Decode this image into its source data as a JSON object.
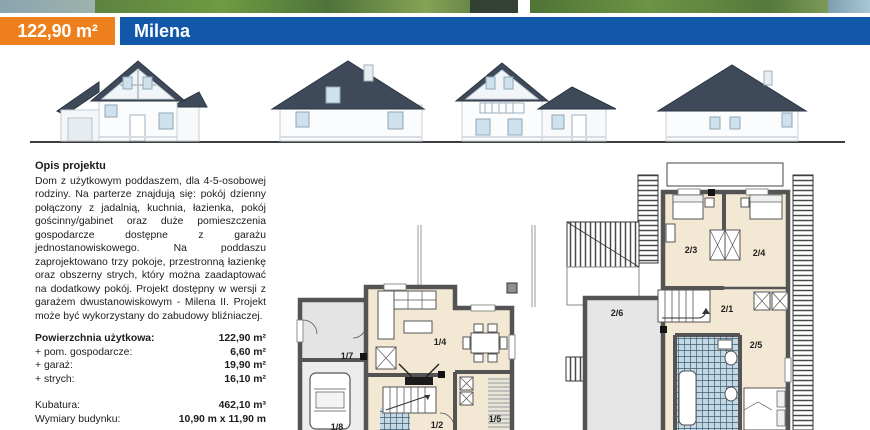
{
  "header": {
    "area": "122,90 m²",
    "title": "Milena",
    "colors": {
      "orange": "#ee7f1d",
      "blue": "#1159a8"
    }
  },
  "description": {
    "heading": "Opis projektu",
    "body": "Dom z użytkowym poddaszem, dla 4-5-osobowej rodziny. Na parterze znajdują się: pokój dzienny połączony z jadalnią, kuchnia, łazienka, pokój gościnny/gabinet oraz duże pomieszczenia gospodarcze dostępne z garażu jednostanowiskowego. Na poddaszu zaprojektowano trzy pokoje, przestronną łazienkę oraz obszerny strych, który można zaadaptować na dodatkowy pokój. Projekt dostępny w wersji z garażem dwustanowiskowym - Milena II. Projekt może być wykorzystany do zabudowy bliźniaczej."
  },
  "specs": {
    "rows": [
      {
        "label": "Powierzchnia użytkowa:",
        "value": "122,90 m²"
      },
      {
        "label": "+ pom. gospodarcze:",
        "value": "6,60 m²"
      },
      {
        "label": "+ garaż:",
        "value": "19,90 m²"
      },
      {
        "label": "+ strych:",
        "value": "16,10 m²"
      },
      {
        "label": "Kubatura:",
        "value": "462,10 m³"
      },
      {
        "label": "Wymiary budynku:",
        "value": "10,90 m x 11,90 m"
      }
    ]
  },
  "plans": {
    "ground": {
      "labels": {
        "utility": "1/7",
        "living": "1/4",
        "hall": "1/2",
        "kitchen": "1/5",
        "garage": "1/8"
      }
    },
    "upper": {
      "labels": {
        "hall": "2/1",
        "bedroom_left": "2/3",
        "bedroom_right": "2/4",
        "bedroom_bottom": "2/5",
        "attic": "2/6"
      }
    }
  }
}
